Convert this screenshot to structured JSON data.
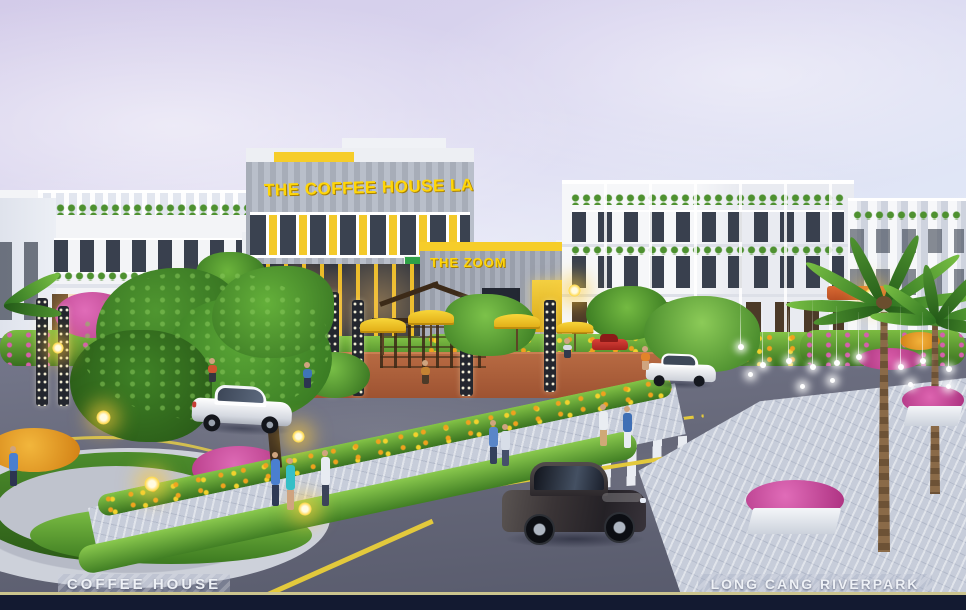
{
  "signs": {
    "coffee_house_facade": "THE COFFEE HOUSE LA",
    "annex_banner": "THE ZOOM"
  },
  "captions": {
    "bottom_left": "COFFEE HOUSE",
    "bottom_right": "LONG CANG RIVERPARK"
  },
  "palette": {
    "accent_yellow": "#F6CD29",
    "sky_lavender": "#D5CDEA",
    "sky_light": "#E9EFF9",
    "building_white": "#F3F4F7",
    "cladding_gray": "#A7ADB8",
    "road_gray": "#64667A",
    "sidewalk_gray": "#C7CDDA",
    "foliage_green": "#5FA32E",
    "flower_magenta": "#CE459B",
    "flower_orange": "#E8921C",
    "footer_navy": "#131A31",
    "footer_gold": "#CBC48E"
  }
}
